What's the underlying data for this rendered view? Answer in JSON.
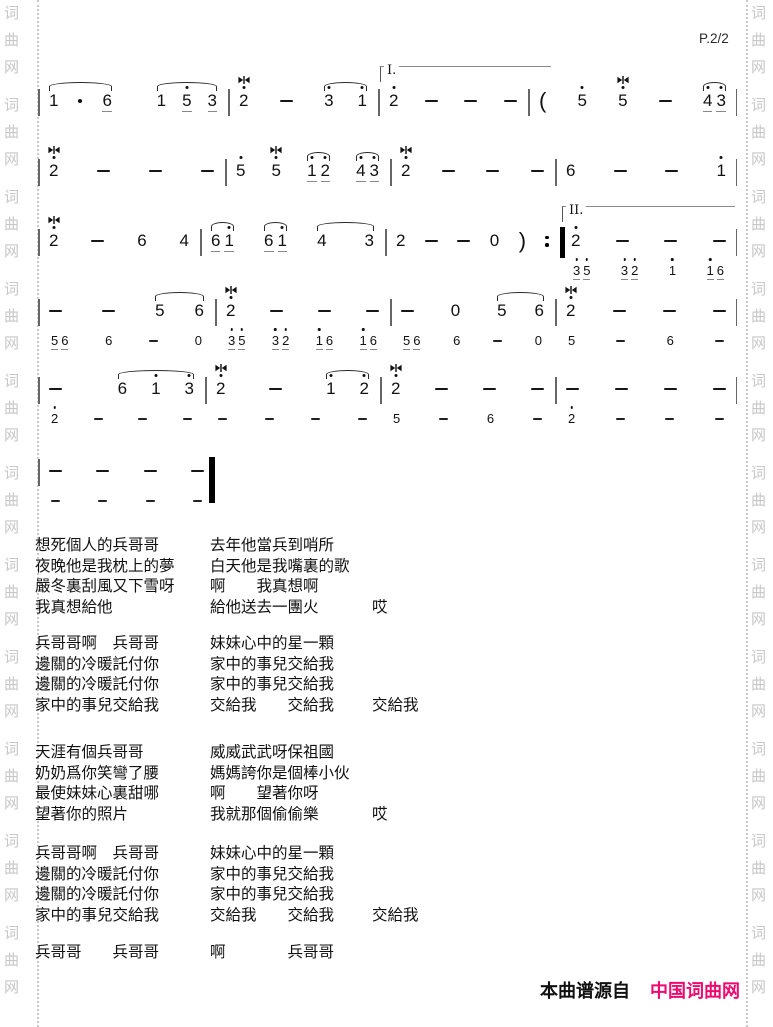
{
  "page": {
    "number_label": "P.2/2",
    "footer": {
      "prefix": "本曲谱源自",
      "site": "中国词曲网"
    },
    "colors": {
      "accent_pink": "#ee0a6e",
      "watermark": "#c7c7c7",
      "music_ink": "#111111",
      "barline": "#666666"
    },
    "watermark_chars": [
      "词",
      "曲",
      "网"
    ],
    "watermark_groups": 11
  },
  "music": {
    "notation": "jianpu",
    "systems": [
      {
        "top": 86,
        "hasSub": false,
        "measures": [
          {
            "w": 190,
            "main": [
              {
                "g": [
                  {
                    "n": "1"
                  },
                  {
                    "aug": true
                  },
                  {
                    "n": "6",
                    "u": 1
                  }
                ],
                "slur": true,
                "sp": 20
              },
              {
                "g": [
                  {
                    "n": "1"
                  },
                  {
                    "n": "5",
                    "d": 1,
                    "u": 1
                  },
                  {
                    "n": "3",
                    "u": 1
                  }
                ],
                "slur": true,
                "sp": 16
              }
            ]
          },
          {
            "w": 150,
            "main": [
              {
                "n": "2",
                "d": 1,
                "tr": true
              },
              {
                "dash": true
              },
              {
                "g": [
                  {
                    "n": "3",
                    "d": 1
                  },
                  {
                    "n": "1",
                    "d": 1
                  }
                ],
                "slur": true,
                "sp": 24
              }
            ]
          },
          {
            "w": 150,
            "volta": {
              "label": "I.",
              "w": 170
            },
            "main": [
              {
                "n": "2",
                "d": 1
              },
              {
                "dash": true
              },
              {
                "dash": true
              },
              {
                "dash": true
              }
            ]
          },
          {
            "w": 209,
            "main": [
              {
                "par": "("
              },
              {
                "n": "5",
                "d": 1
              },
              {
                "n": "5",
                "d": 1,
                "tr": true
              },
              {
                "dash": true
              },
              {
                "g": [
                  {
                    "n": "4",
                    "d": 1,
                    "u": 1
                  },
                  {
                    "n": "3",
                    "d": 1,
                    "u": 1
                  }
                ],
                "slur": true,
                "sp": 4
              }
            ]
          }
        ]
      },
      {
        "top": 156,
        "hasSub": false,
        "measures": [
          {
            "w": 187,
            "main": [
              {
                "n": "2",
                "d": 1,
                "tr": true
              },
              {
                "dash": true
              },
              {
                "dash": true
              },
              {
                "dash": true
              }
            ]
          },
          {
            "w": 165,
            "main": [
              {
                "n": "5",
                "d": 1
              },
              {
                "n": "5",
                "d": 1,
                "tr": true
              },
              {
                "g": [
                  {
                    "n": "1",
                    "d": 1,
                    "u": 1
                  },
                  {
                    "n": "2",
                    "d": 1,
                    "u": 1
                  }
                ],
                "slur": true,
                "sp": 4
              },
              {
                "g": [
                  {
                    "n": "4",
                    "d": 1,
                    "u": 1
                  },
                  {
                    "n": "3",
                    "d": 1,
                    "u": 1
                  }
                ],
                "slur": true,
                "sp": 4
              }
            ]
          },
          {
            "w": 165,
            "main": [
              {
                "n": "2",
                "d": 1,
                "tr": true
              },
              {
                "dash": true
              },
              {
                "dash": true
              },
              {
                "dash": true
              }
            ]
          },
          {
            "w": 182,
            "main": [
              {
                "n": "6"
              },
              {
                "dash": true
              },
              {
                "dash": true
              },
              {
                "n": "1",
                "d": 1
              }
            ]
          }
        ]
      },
      {
        "top": 226,
        "hasSub": true,
        "measures": [
          {
            "w": 162,
            "main": [
              {
                "n": "2",
                "d": 1,
                "tr": true
              },
              {
                "dash": true
              },
              {
                "n": "6"
              },
              {
                "n": "4"
              }
            ]
          },
          {
            "w": 185,
            "main": [
              {
                "g": [
                  {
                    "n": "6",
                    "u": 1
                  },
                  {
                    "n": "1",
                    "d": 1,
                    "u": 1
                  }
                ],
                "slur": true,
                "sp": 4
              },
              {
                "g": [
                  {
                    "n": "6",
                    "u": 1
                  },
                  {
                    "n": "1",
                    "d": 1,
                    "u": 1
                  }
                ],
                "slur": true,
                "sp": 4
              },
              {
                "g": [
                  {
                    "n": "4"
                  },
                  {
                    "n": "3"
                  }
                ],
                "slur": true,
                "sp": 38
              }
            ]
          },
          {
            "w": 175,
            "main": [
              {
                "n": "2"
              },
              {
                "dash": true
              },
              {
                "dash": true
              },
              {
                "n": "0"
              },
              {
                "par": ")"
              },
              {
                "rep": true
              }
            ]
          },
          {
            "w": 177,
            "thick": true,
            "volta": {
              "label": "II.",
              "w": 172
            },
            "main": [
              {
                "n": "2",
                "d": 1
              },
              {
                "dash": true
              },
              {
                "dash": true
              },
              {
                "dash": true
              }
            ],
            "sub": [
              {
                "g": [
                  {
                    "n": "3",
                    "d": 1,
                    "u": 1
                  },
                  {
                    "n": "5",
                    "d": 1,
                    "u": 1
                  }
                ],
                "sp": 3
              },
              {
                "g": [
                  {
                    "n": "3",
                    "d": 1,
                    "u": 1
                  },
                  {
                    "n": "2",
                    "d": 1,
                    "u": 1
                  }
                ],
                "sp": 3
              },
              {
                "n": "1",
                "d": 1
              },
              {
                "g": [
                  {
                    "n": "1",
                    "d": 1,
                    "u": 1
                  },
                  {
                    "n": "6",
                    "u": 1
                  }
                ],
                "sp": 3
              }
            ]
          }
        ]
      },
      {
        "top": 296,
        "hasSub": true,
        "measures": [
          {
            "w": 177,
            "main": [
              {
                "dash": true
              },
              {
                "dash": true
              },
              {
                "g": [
                  {
                    "n": "5"
                  },
                  {
                    "n": "6"
                  }
                ],
                "slur": true,
                "sp": 30
              }
            ],
            "sub": [
              {
                "g": [
                  {
                    "n": "5",
                    "u": 1
                  },
                  {
                    "n": "6",
                    "u": 1
                  }
                ],
                "sp": 3
              },
              {
                "n": "6"
              },
              {
                "dash": true
              },
              {
                "n": "0"
              }
            ]
          },
          {
            "w": 175,
            "main": [
              {
                "n": "2",
                "d": 1,
                "tr": true
              },
              {
                "dash": true
              },
              {
                "dash": true
              },
              {
                "dash": true
              }
            ],
            "sub": [
              {
                "g": [
                  {
                    "n": "3",
                    "d": 1,
                    "u": 1
                  },
                  {
                    "n": "5",
                    "d": 1,
                    "u": 1
                  }
                ],
                "sp": 3
              },
              {
                "g": [
                  {
                    "n": "3",
                    "d": 1,
                    "u": 1
                  },
                  {
                    "n": "2",
                    "d": 1,
                    "u": 1
                  }
                ],
                "sp": 3
              },
              {
                "g": [
                  {
                    "n": "1",
                    "d": 1,
                    "u": 1
                  },
                  {
                    "n": "6",
                    "u": 1
                  }
                ],
                "sp": 3
              },
              {
                "g": [
                  {
                    "n": "1",
                    "d": 1,
                    "u": 1
                  },
                  {
                    "n": "6",
                    "u": 1
                  }
                ],
                "sp": 3
              }
            ]
          },
          {
            "w": 165,
            "main": [
              {
                "dash": true
              },
              {
                "n": "0"
              },
              {
                "g": [
                  {
                    "n": "5"
                  },
                  {
                    "n": "6"
                  }
                ],
                "slur": true,
                "sp": 28
              }
            ],
            "sub": [
              {
                "g": [
                  {
                    "n": "5",
                    "u": 1
                  },
                  {
                    "n": "6",
                    "u": 1
                  }
                ],
                "sp": 3
              },
              {
                "n": "6"
              },
              {
                "dash": true
              },
              {
                "n": "0"
              }
            ]
          },
          {
            "w": 182,
            "main": [
              {
                "n": "2",
                "d": 1,
                "tr": true
              },
              {
                "dash": true
              },
              {
                "dash": true
              },
              {
                "dash": true
              }
            ],
            "sub": [
              {
                "n": "5"
              },
              {
                "dash": true
              },
              {
                "n": "6"
              },
              {
                "dash": true
              }
            ]
          }
        ]
      },
      {
        "top": 374,
        "hasSub": true,
        "measures": [
          {
            "w": 167,
            "main": [
              {
                "dash": true
              },
              {
                "g": [
                  {
                    "n": "6"
                  },
                  {
                    "n": "1",
                    "d": 1
                  },
                  {
                    "n": "3",
                    "d": 1
                  }
                ],
                "slur": true,
                "sp": 24
              }
            ],
            "sub": [
              {
                "n": "2",
                "d": 1
              },
              {
                "dash": true
              },
              {
                "dash": true
              },
              {
                "dash": true
              }
            ]
          },
          {
            "w": 175,
            "main": [
              {
                "n": "2",
                "d": 1,
                "tr": true
              },
              {
                "dash": true
              },
              {
                "g": [
                  {
                    "n": "1",
                    "d": 1
                  },
                  {
                    "n": "2",
                    "d": 1
                  }
                ],
                "slur": true,
                "sp": 24
              }
            ],
            "sub": [
              {
                "dash": true
              },
              {
                "dash": true
              },
              {
                "dash": true
              },
              {
                "dash": true
              }
            ]
          },
          {
            "w": 175,
            "main": [
              {
                "n": "2",
                "d": 1,
                "tr": true
              },
              {
                "dash": true
              },
              {
                "dash": true
              },
              {
                "dash": true
              }
            ],
            "sub": [
              {
                "n": "5"
              },
              {
                "dash": true
              },
              {
                "n": "6"
              },
              {
                "dash": true
              }
            ]
          },
          {
            "w": 182,
            "main": [
              {
                "dash": true
              },
              {
                "dash": true
              },
              {
                "dash": true
              },
              {
                "dash": true
              }
            ],
            "sub": [
              {
                "n": "2",
                "d": 1
              },
              {
                "dash": true
              },
              {
                "dash": true
              },
              {
                "dash": true
              }
            ]
          }
        ]
      },
      {
        "top": 456,
        "hasSub": true,
        "measures": [
          {
            "w": 177,
            "end": "final",
            "main": [
              {
                "dash": true
              },
              {
                "dash": true
              },
              {
                "dash": true
              },
              {
                "dash": true
              }
            ],
            "sub": [
              {
                "dash": true
              },
              {
                "dash": true
              },
              {
                "dash": true
              },
              {
                "dash": true
              }
            ]
          }
        ]
      }
    ]
  },
  "lyrics": {
    "stanzas": [
      {
        "lines": [
          {
            "left": "想死個人的兵哥哥",
            "right": "去年他當兵到哨所"
          },
          {
            "left": "夜晚他是我枕上的夢",
            "right": "白天他是我嘴裏的歌"
          },
          {
            "left": "嚴冬裏刮風又下雪呀",
            "right": "啊　　我真想啊"
          },
          {
            "left": "我真想給他",
            "right": "給他送去一團火",
            "tail": "哎"
          }
        ]
      },
      {
        "lines": [
          {
            "left": "兵哥哥啊　兵哥哥",
            "right": "妹妹心中的星一顆"
          },
          {
            "left": "邊關的冷暖託付你",
            "right": "家中的事兒交給我"
          },
          {
            "left": "邊關的冷暖託付你",
            "right": "家中的事兒交給我"
          },
          {
            "left": "家中的事兒交給我",
            "right": "交給我　　交給我",
            "tail": "交給我"
          }
        ]
      },
      {
        "lines": [
          {
            "left": "天涯有個兵哥哥",
            "right": "威威武武呀保祖國"
          },
          {
            "left": "奶奶爲你笑彎了腰",
            "right": "媽媽誇你是個棒小伙"
          },
          {
            "left": "最使妹妹心裏甜哪",
            "right": "啊　　望著你呀"
          },
          {
            "left": "望著你的照片",
            "right": "我就那個偷偷樂",
            "tail": "哎"
          }
        ]
      },
      {
        "lines": [
          {
            "left": "兵哥哥啊　兵哥哥",
            "right": "妹妹心中的星一顆"
          },
          {
            "left": "邊關的冷暖託付你",
            "right": "家中的事兒交給我"
          },
          {
            "left": "邊關的冷暖託付你",
            "right": "家中的事兒交給我"
          },
          {
            "left": "家中的事兒交給我",
            "right": "交給我　　交給我",
            "tail": "交給我"
          }
        ]
      },
      {
        "lines": [
          {
            "left": "兵哥哥　　兵哥哥",
            "right": "啊　　　　兵哥哥"
          }
        ]
      }
    ]
  }
}
